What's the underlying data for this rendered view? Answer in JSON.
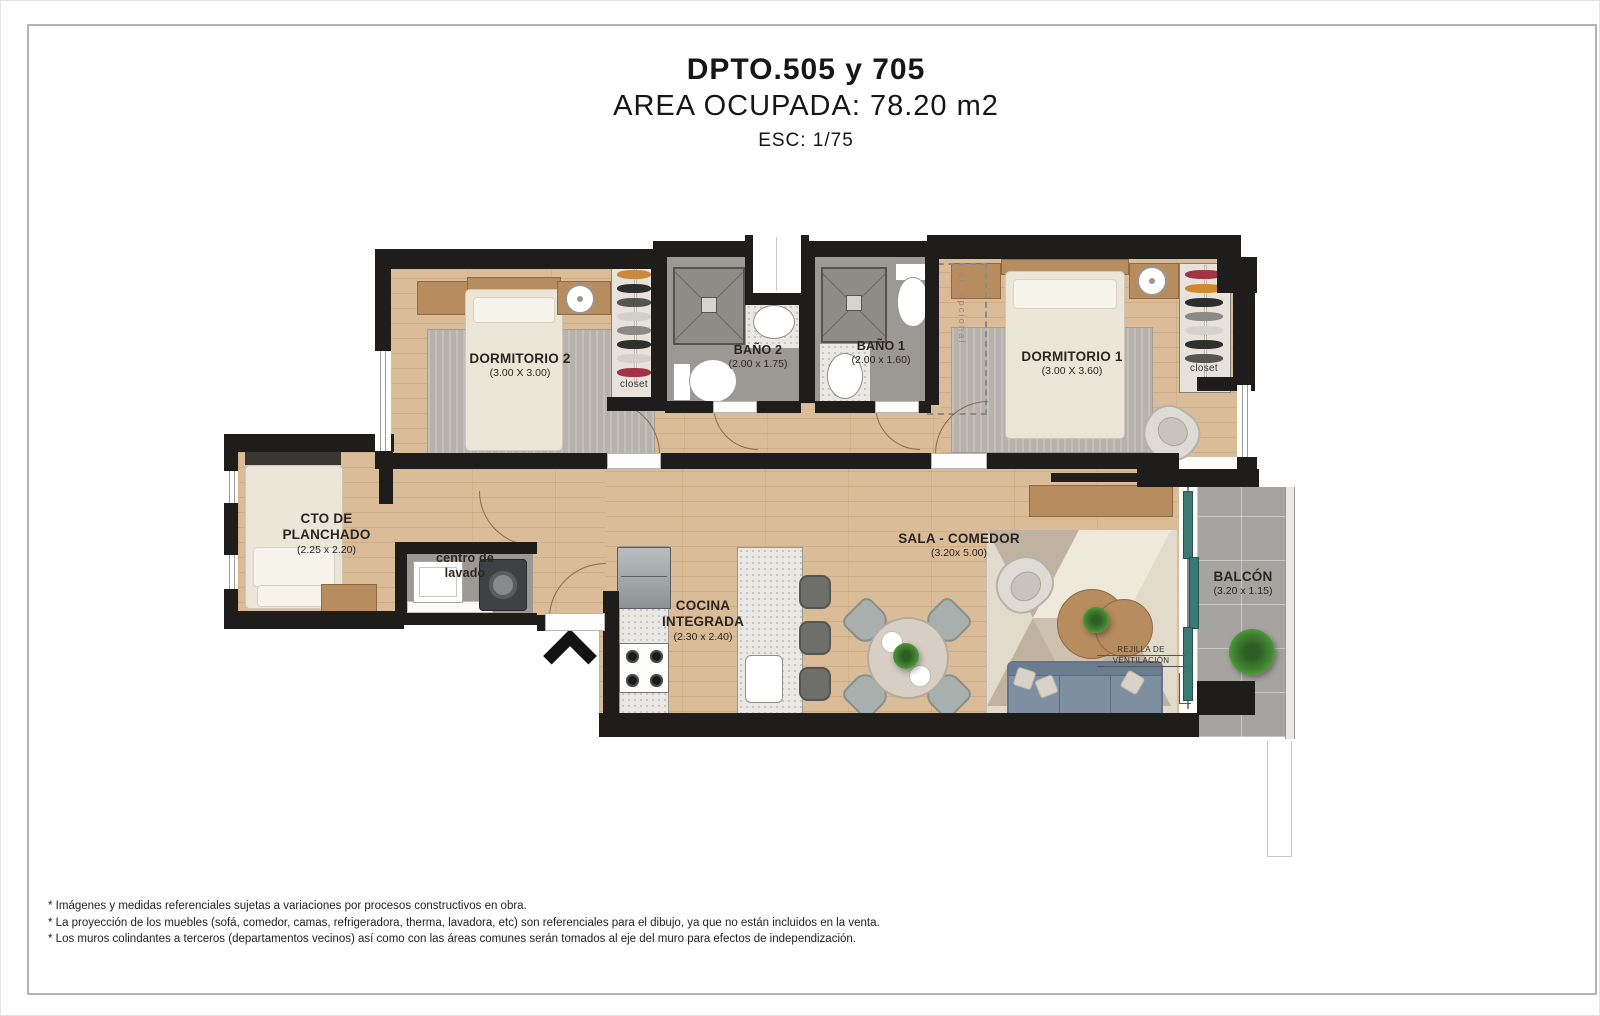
{
  "header": {
    "title": "DPTO.505 y 705",
    "area": "AREA OCUPADA: 78.20 m2",
    "scale": "ESC: 1/75"
  },
  "rooms": {
    "dormitorio2": {
      "name": "DORMITORIO 2",
      "dims": "(3.00 X 3.00)"
    },
    "bano2": {
      "name": "BAÑO 2",
      "dims": "(2.00 x 1.75)"
    },
    "bano1": {
      "name": "BAÑO 1",
      "dims": "(2.00 x 1.60)"
    },
    "dormitorio1": {
      "name": "DORMITORIO 1",
      "dims": "(3.00 X 3.60)"
    },
    "cto_planchado": {
      "line1": "CTO DE",
      "line2": "PLANCHADO",
      "dims": "(2.25 x 2.20)"
    },
    "centro_lavado": {
      "line1": "centro de",
      "line2": "lavado"
    },
    "cocina": {
      "line1": "COCINA",
      "line2": "INTEGRADA",
      "dims": "(2.30 x 2.40)"
    },
    "sala": {
      "name": "SALA - COMEDOR",
      "dims": "(3.20x 5.00)"
    },
    "balcon": {
      "name": "BALCÓN",
      "dims": "(3.20 x 1.15)"
    }
  },
  "annotations": {
    "closet_dorm2": "closet",
    "closet_dorm1": "closet",
    "closet_opcional": "cl. opcional",
    "rejilla_line1": "REJILLA DE",
    "rejilla_line2": "VENTILACIÓN"
  },
  "footnotes": [
    "* Imágenes y medidas referenciales sujetas a variaciones por procesos constructivos en obra.",
    "* La proyección de los muebles (sofá, comedor, camas, refrigeradora, therma, lavadora, etc) son referenciales para el dibujo, ya que no están incluidos en la venta.",
    "* Los muros colindantes a terceros (departamentos vecinos) así como con las áreas comunes serán tomados al eje del muro para efectos de independización."
  ],
  "colors": {
    "wall": "#1e1d1b",
    "wood_floor": "#dabc98",
    "bath_floor": "#9c9893",
    "balcony_glass": "#3a7a72",
    "label_text": "#2b2520"
  }
}
